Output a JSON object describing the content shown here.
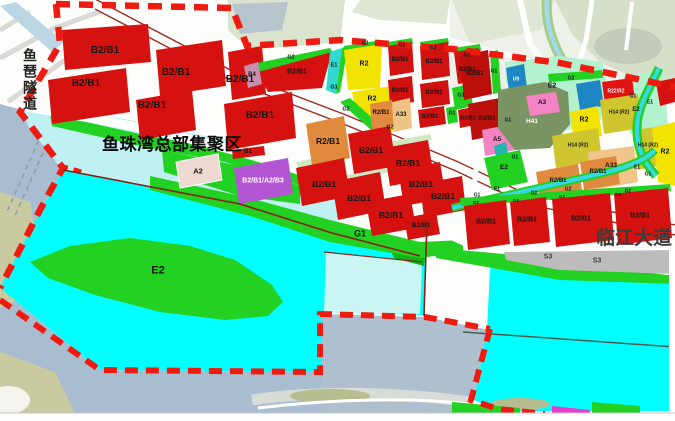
{
  "map": {
    "region_title": "鱼珠湾总部集聚区",
    "tunnel_name": "鱼琶隧道",
    "road_name": "临江大道",
    "colors": {
      "site_boundary_red": "#ef1a10",
      "commercial_red": "#d5120f",
      "commercial_dark_red": "#bb0f0c",
      "residential_yellow": "#f2e400",
      "mixed_orange": "#e08a3e",
      "civic_tan": "#efc58a",
      "mixed_purple": "#b455d4",
      "park_green": "#22d122",
      "mint_green": "#b2f2cf",
      "village_olive": "#cfc52f",
      "sage_green": "#7b9464",
      "utility_blue": "#1f86c4",
      "pink": "#f383c3",
      "pale_pink": "#eed8d2",
      "water_cyan": "#00ffff",
      "pale_cyan": "#c9f5f3",
      "river_gray": "#a9bdd0",
      "road_strip_gray": "#bcbcbc"
    },
    "labels": [
      {
        "t": "B2/B1",
        "x": 105,
        "y": 51,
        "s": 10
      },
      {
        "t": "B2/B1",
        "x": 86,
        "y": 84,
        "s": 10
      },
      {
        "t": "B2/B1",
        "x": 152,
        "y": 106,
        "s": 10
      },
      {
        "t": "B2/B1",
        "x": 176,
        "y": 73,
        "s": 10
      },
      {
        "t": "B2/B1",
        "x": 240,
        "y": 80,
        "s": 10
      },
      {
        "t": "B2/B1",
        "x": 260,
        "y": 116,
        "s": 10
      },
      {
        "t": "B2/B1",
        "x": 297,
        "y": 72,
        "s": 7
      },
      {
        "t": "B4",
        "x": 252,
        "y": 75,
        "s": 6
      },
      {
        "t": "G2",
        "x": 291,
        "y": 58,
        "s": 5.5
      },
      {
        "t": "E1",
        "x": 334,
        "y": 66,
        "s": 5.5
      },
      {
        "t": "G1",
        "x": 334,
        "y": 88,
        "s": 5.5
      },
      {
        "t": "G2",
        "x": 365,
        "y": 44,
        "s": 5
      },
      {
        "t": "R2",
        "x": 364,
        "y": 64,
        "s": 7
      },
      {
        "t": "R2",
        "x": 372,
        "y": 99,
        "s": 7
      },
      {
        "t": "G2",
        "x": 346,
        "y": 110,
        "s": 5.5
      },
      {
        "t": "G2",
        "x": 390,
        "y": 128,
        "s": 5.5
      },
      {
        "t": "G2",
        "x": 402,
        "y": 46,
        "s": 5
      },
      {
        "t": "G2",
        "x": 433,
        "y": 49,
        "s": 5
      },
      {
        "t": "G2",
        "x": 467,
        "y": 56,
        "s": 5
      },
      {
        "t": "B2/B1",
        "x": 400,
        "y": 60,
        "s": 6
      },
      {
        "t": "B2/B1",
        "x": 434,
        "y": 62,
        "s": 6
      },
      {
        "t": "B2/B1",
        "x": 467,
        "y": 70,
        "s": 6
      },
      {
        "t": "B2/B1",
        "x": 400,
        "y": 91,
        "s": 6
      },
      {
        "t": "B2/B1",
        "x": 434,
        "y": 93,
        "s": 6
      },
      {
        "t": "G1",
        "x": 461,
        "y": 96,
        "s": 5.5
      },
      {
        "t": "B2/B1",
        "x": 430,
        "y": 117,
        "s": 6
      },
      {
        "t": "G1",
        "x": 452,
        "y": 114,
        "s": 5
      },
      {
        "t": "B2/B1",
        "x": 468,
        "y": 119,
        "s": 5.5
      },
      {
        "t": "R2/B1",
        "x": 381,
        "y": 113,
        "s": 6
      },
      {
        "t": "A33",
        "x": 401,
        "y": 115,
        "s": 6
      },
      {
        "t": "R2/B1",
        "x": 328,
        "y": 141,
        "s": 8.5
      },
      {
        "t": "B2/B1",
        "x": 371,
        "y": 150,
        "s": 8.5
      },
      {
        "t": "B2/B1",
        "x": 408,
        "y": 163,
        "s": 8.5
      },
      {
        "t": "B2/B1",
        "x": 324,
        "y": 184,
        "s": 8.5
      },
      {
        "t": "B2/B1",
        "x": 359,
        "y": 198,
        "s": 8.5
      },
      {
        "t": "B2/B1",
        "x": 421,
        "y": 184,
        "s": 8.5
      },
      {
        "t": "B2/B1",
        "x": 391,
        "y": 215,
        "s": 8.5
      },
      {
        "t": "B2/B1",
        "x": 421,
        "y": 226,
        "s": 6.5
      },
      {
        "t": "B2/B1",
        "x": 443,
        "y": 196,
        "s": 8.5
      },
      {
        "t": "B1",
        "x": 248,
        "y": 152,
        "s": 6.5
      },
      {
        "t": "A2",
        "x": 198,
        "y": 171,
        "s": 7.5
      },
      {
        "t": "B2/B1/A2/B3",
        "x": 263,
        "y": 181,
        "s": 7,
        "c": "w"
      },
      {
        "t": "G1",
        "x": 360,
        "y": 234,
        "s": 9
      },
      {
        "t": "E2",
        "x": 158,
        "y": 271,
        "s": 11
      },
      {
        "t": "B2/B1",
        "x": 475,
        "y": 74,
        "s": 6
      },
      {
        "t": "G1",
        "x": 494,
        "y": 72,
        "s": 5
      },
      {
        "t": "B2/B1",
        "x": 487,
        "y": 119,
        "s": 6
      },
      {
        "t": "G1",
        "x": 508,
        "y": 121,
        "s": 5
      },
      {
        "t": "A5",
        "x": 497,
        "y": 140,
        "s": 6.5
      },
      {
        "t": "E2",
        "x": 504,
        "y": 168,
        "s": 6.5
      },
      {
        "t": "G1",
        "x": 515,
        "y": 158,
        "s": 5
      },
      {
        "t": "U9",
        "x": 516,
        "y": 80,
        "s": 5,
        "c": "w"
      },
      {
        "t": "E2",
        "x": 552,
        "y": 86,
        "s": 7
      },
      {
        "t": "A3",
        "x": 542,
        "y": 103,
        "s": 6.5
      },
      {
        "t": "H41",
        "x": 532,
        "y": 122,
        "s": 6.5,
        "c": "w"
      },
      {
        "t": "G2",
        "x": 571,
        "y": 79,
        "s": 5
      },
      {
        "t": "R22/R2",
        "x": 616,
        "y": 92,
        "s": 5,
        "c": "w"
      },
      {
        "t": "R2",
        "x": 584,
        "y": 120,
        "s": 7
      },
      {
        "t": "H14 (R2)",
        "x": 619,
        "y": 113,
        "s": 5
      },
      {
        "t": "H14 (R2)",
        "x": 578,
        "y": 146,
        "s": 5
      },
      {
        "t": "H14 (R2)",
        "x": 648,
        "y": 146,
        "s": 5
      },
      {
        "t": "A33",
        "x": 611,
        "y": 166,
        "s": 6.5
      },
      {
        "t": "E2",
        "x": 636,
        "y": 110,
        "s": 6
      },
      {
        "t": "G1",
        "x": 633,
        "y": 97,
        "s": 5
      },
      {
        "t": "E1",
        "x": 650,
        "y": 103,
        "s": 5
      },
      {
        "t": "E1",
        "x": 637,
        "y": 168,
        "s": 5
      },
      {
        "t": "G1",
        "x": 648,
        "y": 175,
        "s": 5
      },
      {
        "t": "R2",
        "x": 665,
        "y": 152,
        "s": 7
      },
      {
        "t": "G2",
        "x": 628,
        "y": 192,
        "s": 5
      },
      {
        "t": "R2/B1",
        "x": 558,
        "y": 181,
        "s": 6
      },
      {
        "t": "R2/B1",
        "x": 598,
        "y": 172,
        "s": 6
      },
      {
        "t": "G2",
        "x": 534,
        "y": 194,
        "s": 5
      },
      {
        "t": "G2",
        "x": 568,
        "y": 190,
        "s": 5
      },
      {
        "t": "E1",
        "x": 497,
        "y": 190,
        "s": 5
      },
      {
        "t": "G1",
        "x": 477,
        "y": 196,
        "s": 5
      },
      {
        "t": "B2/B1",
        "x": 486,
        "y": 222,
        "s": 7
      },
      {
        "t": "B2/B1",
        "x": 527,
        "y": 220,
        "s": 7
      },
      {
        "t": "B2/B1",
        "x": 581,
        "y": 219,
        "s": 7
      },
      {
        "t": "B2/B1",
        "x": 640,
        "y": 216,
        "s": 7
      },
      {
        "t": "G2",
        "x": 476,
        "y": 203,
        "s": 4.5
      },
      {
        "t": "G2",
        "x": 516,
        "y": 201,
        "s": 4.5
      },
      {
        "t": "G2",
        "x": 562,
        "y": 197,
        "s": 4.5
      },
      {
        "t": "G2",
        "x": 618,
        "y": 195,
        "s": 4.5
      },
      {
        "t": "S3",
        "x": 548,
        "y": 257,
        "s": 7,
        "c": "g"
      },
      {
        "t": "S3",
        "x": 597,
        "y": 261,
        "s": 7,
        "c": "g"
      }
    ]
  }
}
